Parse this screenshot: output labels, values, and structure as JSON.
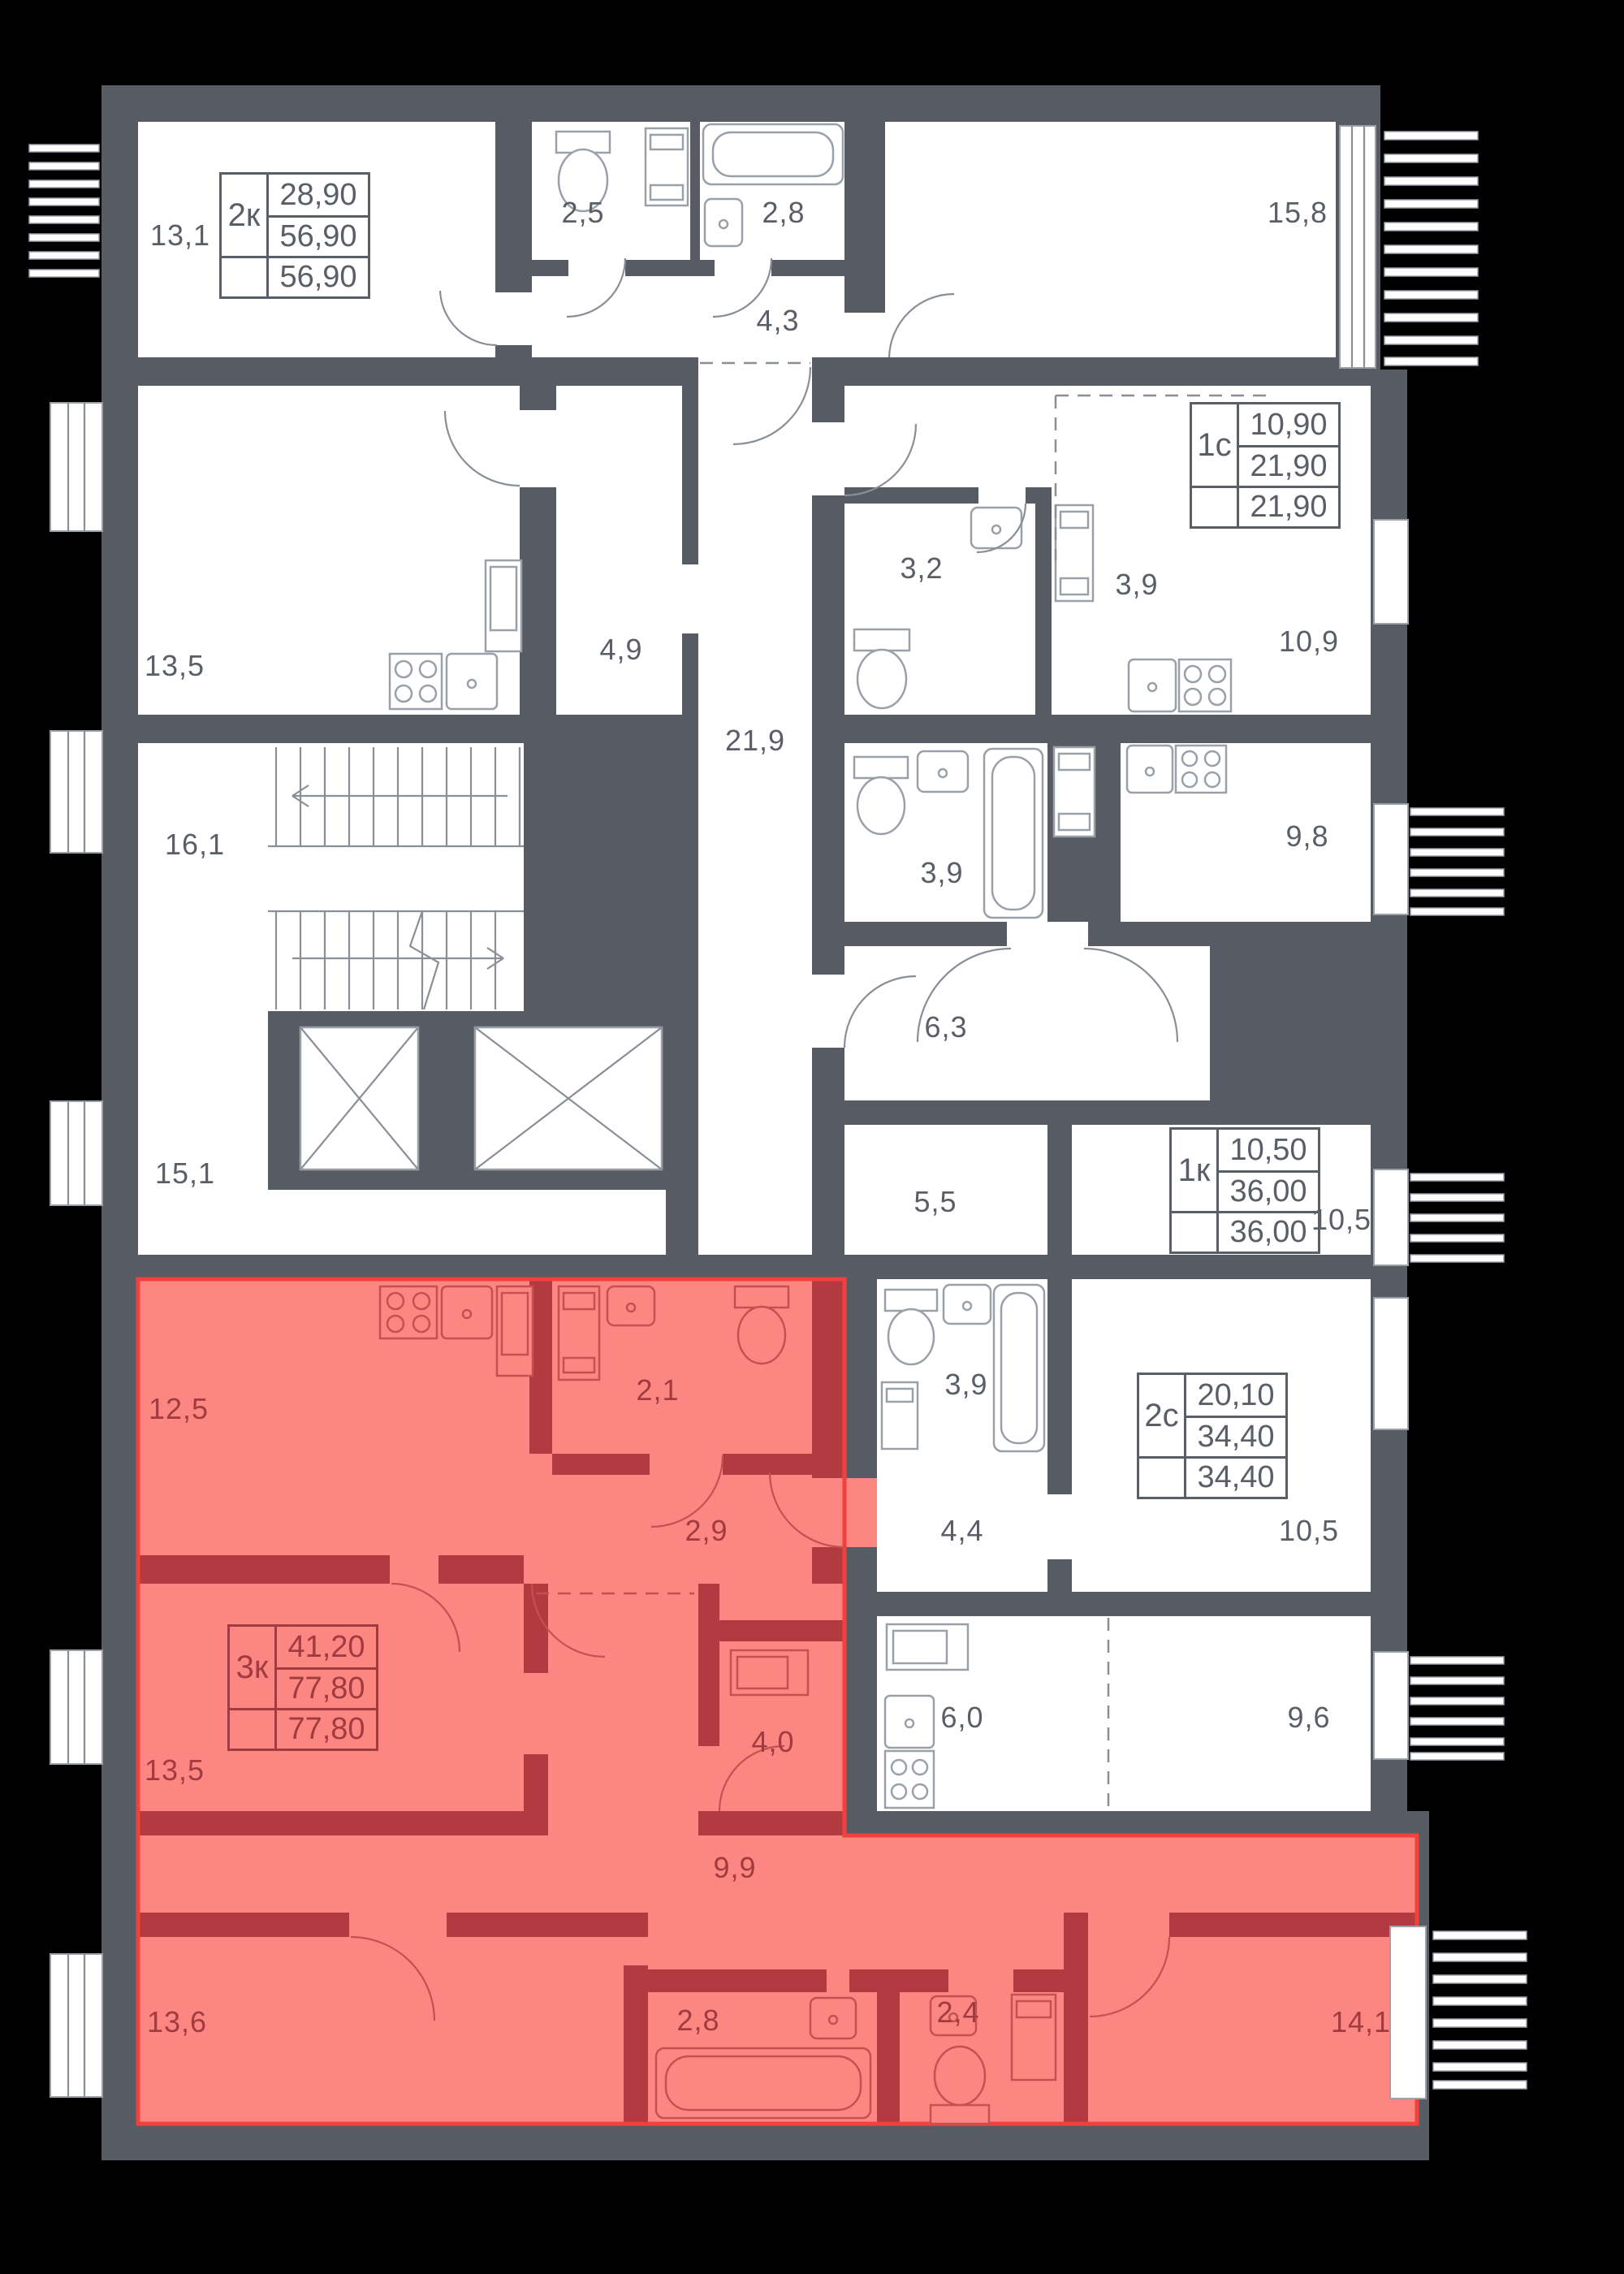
{
  "colors": {
    "background": "#000000",
    "wall": "#575B63",
    "room_fill": "#FFFFFF",
    "highlight_fill": "#FC8782",
    "highlight_wall": "#B23A40",
    "highlight_outline": "#F2413D",
    "label": "#5A5E66",
    "label_highlight": "#A23B40",
    "fixture_stroke": "#9AA0A8"
  },
  "apartments": [
    {
      "id": "apt-2k",
      "type": "2к",
      "values": [
        "28,90",
        "56,90",
        "56,90"
      ],
      "highlighted": false
    },
    {
      "id": "apt-1s",
      "type": "1с",
      "values": [
        "10,90",
        "21,90",
        "21,90"
      ],
      "highlighted": false
    },
    {
      "id": "apt-1k",
      "type": "1к",
      "values": [
        "10,50",
        "36,00",
        "36,00"
      ],
      "highlighted": false
    },
    {
      "id": "apt-2s",
      "type": "2с",
      "values": [
        "20,10",
        "34,40",
        "34,40"
      ],
      "highlighted": false
    },
    {
      "id": "apt-3k",
      "type": "3к",
      "values": [
        "41,20",
        "77,80",
        "77,80"
      ],
      "highlighted": true
    }
  ],
  "rooms": [
    {
      "id": "room-13-1",
      "area": "13,1",
      "highlighted": false
    },
    {
      "id": "bathroom-2-5",
      "area": "2,5",
      "highlighted": false
    },
    {
      "id": "bathroom-2-8",
      "area": "2,8",
      "highlighted": false
    },
    {
      "id": "hallway-4-3",
      "area": "4,3",
      "highlighted": false
    },
    {
      "id": "room-15-8",
      "area": "15,8",
      "highlighted": false
    },
    {
      "id": "room-13-5",
      "area": "13,5",
      "highlighted": false
    },
    {
      "id": "kitchen-4-9",
      "area": "4,9",
      "highlighted": false
    },
    {
      "id": "kitchen-zone-3-9",
      "area": "3,9",
      "highlighted": false
    },
    {
      "id": "bathroom-3-2",
      "area": "3,2",
      "highlighted": false
    },
    {
      "id": "room-10-9",
      "area": "10,9",
      "highlighted": false
    },
    {
      "id": "stairwell-16-1",
      "area": "16,1",
      "highlighted": false
    },
    {
      "id": "corridor-21-9",
      "area": "21,9",
      "highlighted": false
    },
    {
      "id": "bathroom-3-9",
      "area": "3,9",
      "highlighted": false
    },
    {
      "id": "room-9-8",
      "area": "9,8",
      "highlighted": false
    },
    {
      "id": "hallway-6-3",
      "area": "6,3",
      "highlighted": false
    },
    {
      "id": "room-5-5",
      "area": "5,5",
      "highlighted": false
    },
    {
      "id": "room-10-5",
      "area": "10,5",
      "highlighted": false
    },
    {
      "id": "room-15-1",
      "area": "15,1",
      "highlighted": false
    },
    {
      "id": "room-12-5",
      "area": "12,5",
      "highlighted": true
    },
    {
      "id": "bathroom-2-1",
      "area": "2,1",
      "highlighted": true
    },
    {
      "id": "hallway-2-9",
      "area": "2,9",
      "highlighted": true
    },
    {
      "id": "bathroom-3-9-b",
      "area": "3,9",
      "highlighted": false
    },
    {
      "id": "hallway-4-4",
      "area": "4,4",
      "highlighted": false
    },
    {
      "id": "room-10-5-b",
      "area": "10,5",
      "highlighted": false
    },
    {
      "id": "room-13-5-b",
      "area": "13,5",
      "highlighted": true
    },
    {
      "id": "storeroom-4-0",
      "area": "4,0",
      "highlighted": true
    },
    {
      "id": "kitchen-6-0",
      "area": "6,0",
      "highlighted": false
    },
    {
      "id": "room-9-6",
      "area": "9,6",
      "highlighted": false
    },
    {
      "id": "corridor-9-9",
      "area": "9,9",
      "highlighted": true
    },
    {
      "id": "room-13-6",
      "area": "13,6",
      "highlighted": true
    },
    {
      "id": "bathroom-2-8-b",
      "area": "2,8",
      "highlighted": true
    },
    {
      "id": "bathroom-2-4",
      "area": "2,4",
      "highlighted": true
    },
    {
      "id": "room-14-1",
      "area": "14,1",
      "highlighted": true
    }
  ]
}
